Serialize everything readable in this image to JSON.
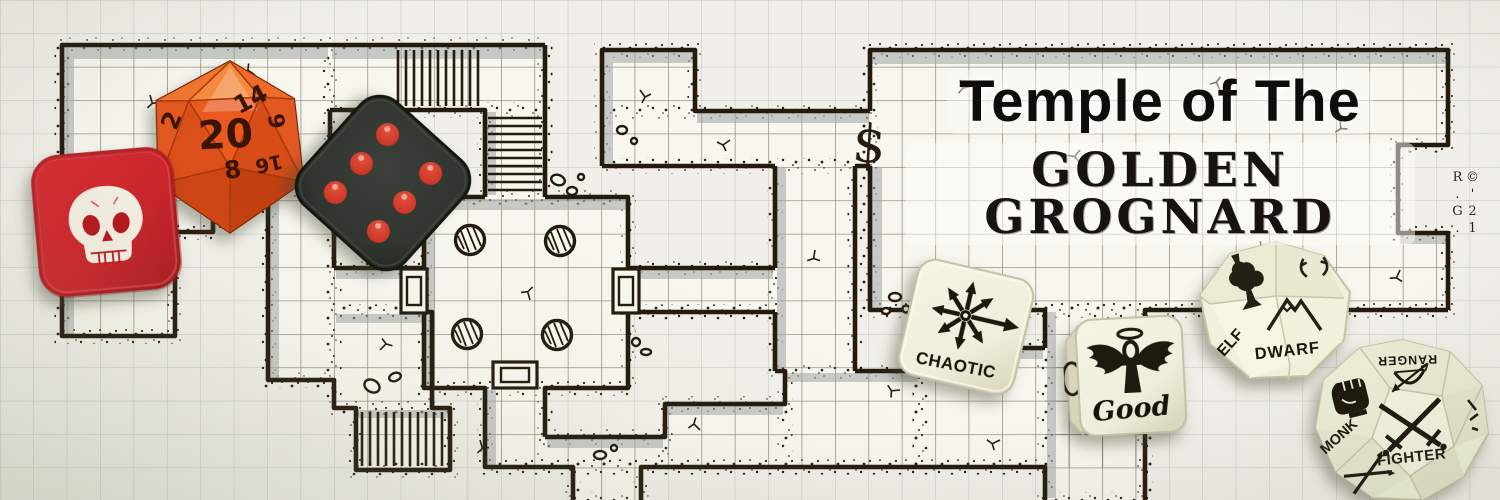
{
  "title": {
    "line1": "Temple of The",
    "line2": "GOLDEN GROGNARD",
    "copyright": "©'21 R.G."
  },
  "map": {
    "treasure_symbol": "$",
    "ink_color": "#241b0e",
    "paper_color": "#f0efe9",
    "shadow_color": "#9fa5a3",
    "features": [
      "graph-paper",
      "dungeon-rooms",
      "staircases",
      "round-pillars",
      "double-doors",
      "rubble-stones"
    ]
  },
  "dice": {
    "d20": {
      "name": "orange-d20",
      "color": "#e95f27",
      "number_color": "#3a1404",
      "numbers": {
        "top": "20",
        "upper_right": "14",
        "left": "2",
        "bottom": "8",
        "right": "6",
        "lower_right": "16"
      }
    },
    "skull": {
      "name": "red-skull-d6",
      "color": "#c9252b",
      "icon": "skull-icon",
      "icon_color": "#f3eee2"
    },
    "pip": {
      "name": "black-d6",
      "color": "#30352f",
      "pip_color": "#cc3726",
      "value": "6"
    },
    "chaotic": {
      "label": "CHAOTIC",
      "icon": "chaos-star-icon",
      "color": "#f2f0dc"
    },
    "good": {
      "label": "Good",
      "icon": "winged-ankh-icon",
      "color": "#f2f0dc"
    },
    "race": {
      "label_left": "ELF",
      "label_right": "DWARF",
      "icons": [
        "tree-icon",
        "mountain-icon"
      ],
      "color": "#eff1da"
    },
    "clazz": {
      "label_left": "MONK",
      "label_center": "FIGHTER",
      "label_top": "RANGER",
      "icons": [
        "fist-icon",
        "crossed-swords-icon",
        "bow-icon"
      ],
      "color": "#eef0d8"
    }
  }
}
